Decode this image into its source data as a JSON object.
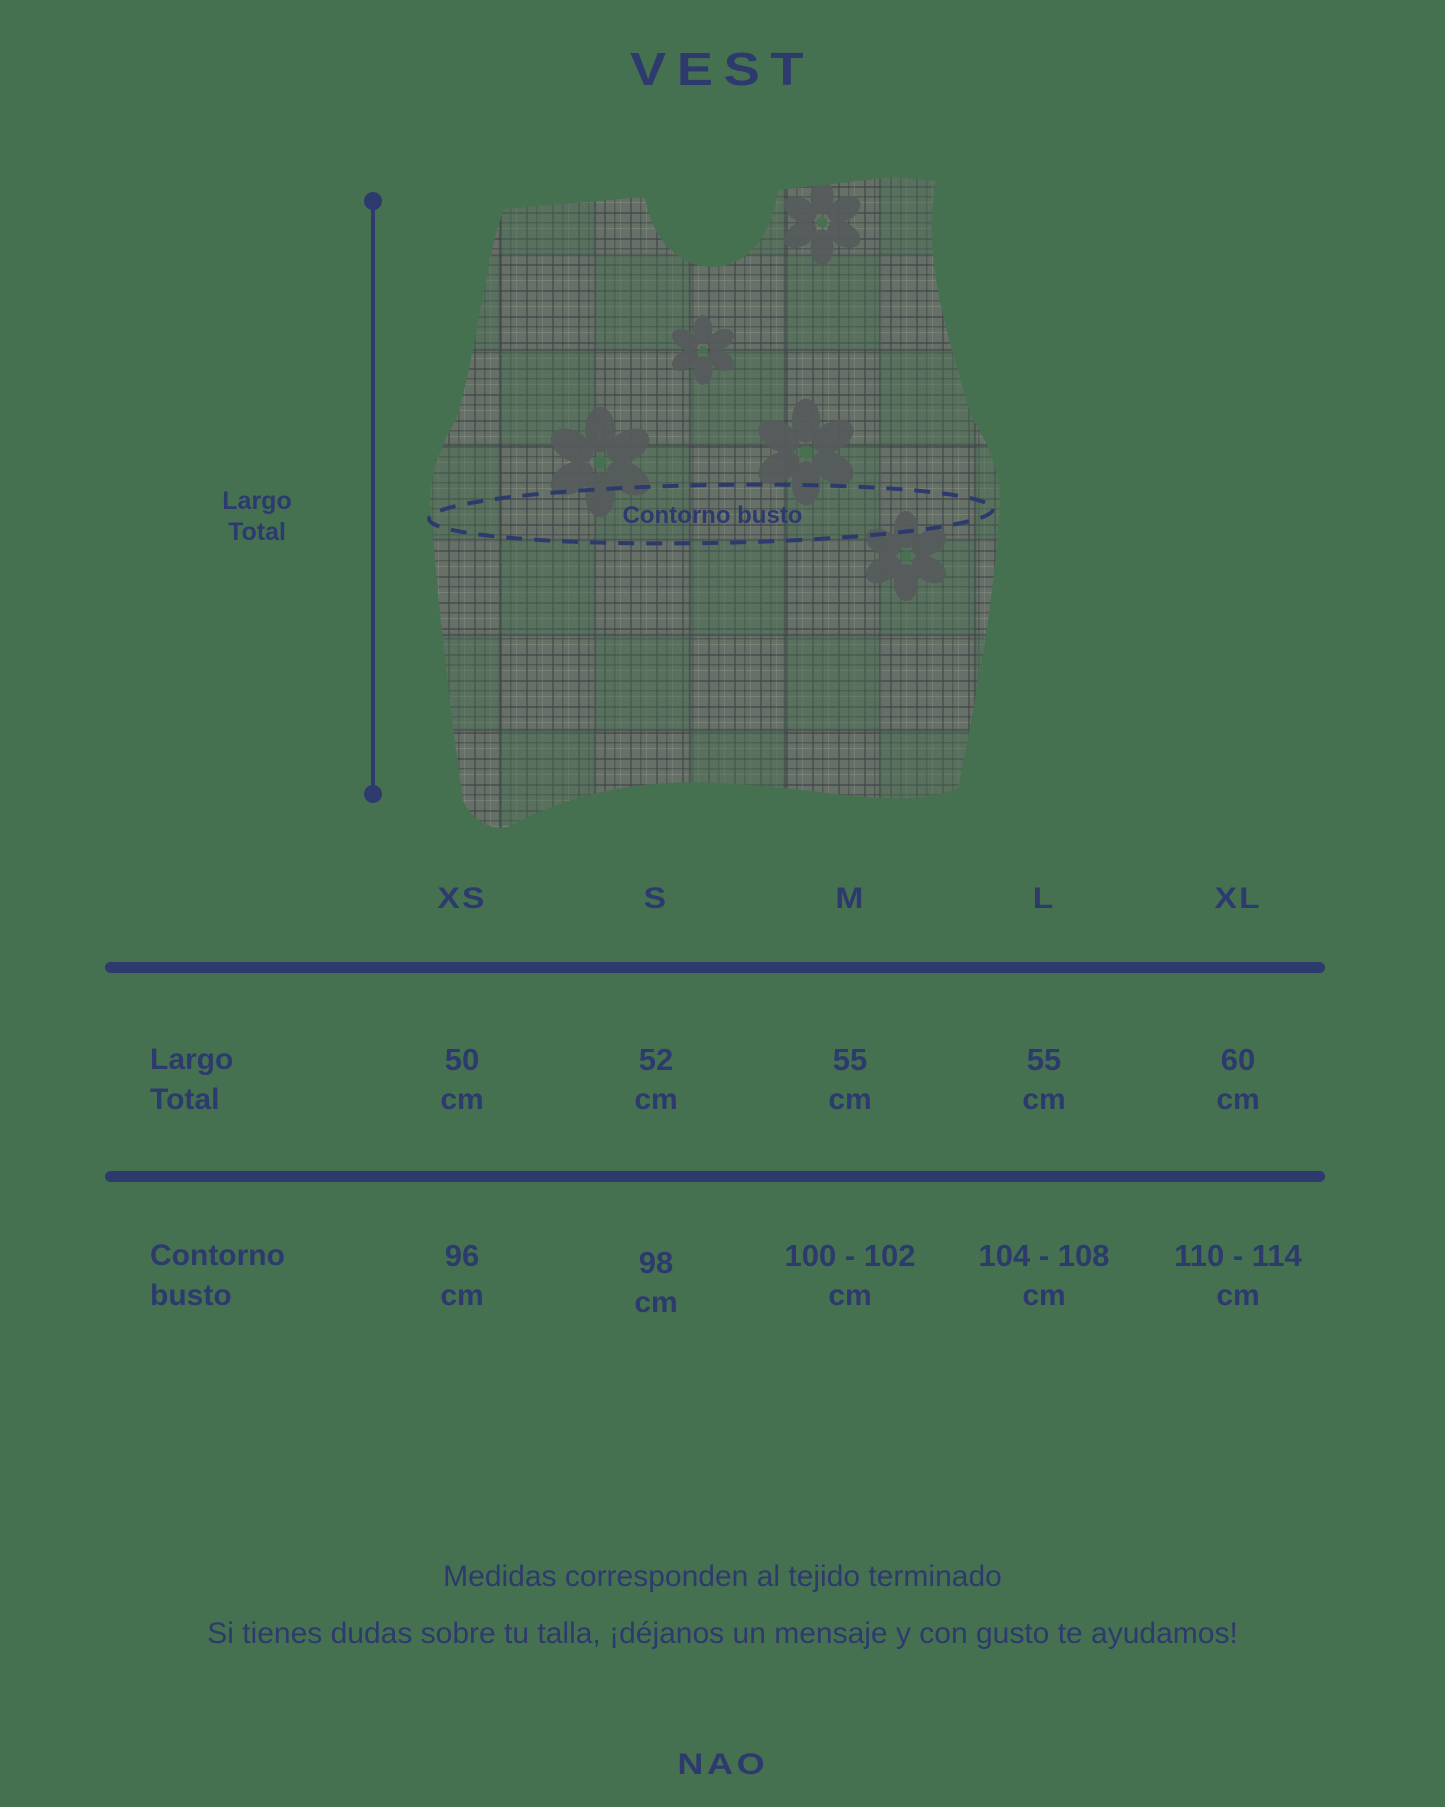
{
  "colors": {
    "background": "#467150",
    "navy": "#2d3a6d",
    "vest_gray": "#6a6f68",
    "flower_gray": "#565b5c"
  },
  "title": "VEST",
  "diagram": {
    "largo_line1": "Largo",
    "largo_line2": "Total",
    "contorno_label": "Contorno busto"
  },
  "table": {
    "sizes": [
      "XS",
      "S",
      "M",
      "L",
      "XL"
    ],
    "rows": [
      {
        "label_line1": "Largo",
        "label_line2": "Total",
        "unit": "cm",
        "values": [
          "50",
          "52",
          "55",
          "55",
          "60"
        ]
      },
      {
        "label_line1": "Contorno",
        "label_line2": "busto",
        "unit": "cm",
        "values": [
          "96",
          "98",
          "100 - 102",
          "104 - 108",
          "110 - 114"
        ]
      }
    ]
  },
  "footer": {
    "note1": "Medidas corresponden al tejido terminado",
    "note2": "Si tienes dudas sobre tu talla, ¡déjanos un mensaje y con gusto te ayudamos!",
    "brand": "NAO"
  }
}
